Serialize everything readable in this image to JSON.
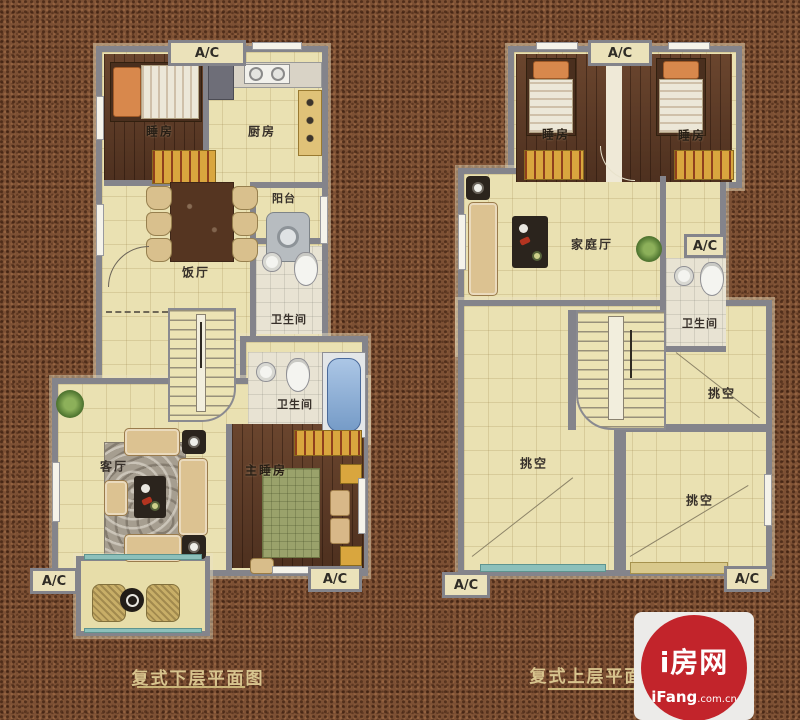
{
  "left_plan": {
    "caption": "复式下层平面图",
    "labels": {
      "ac_top": "A/C",
      "bedroom": "睡房",
      "kitchen": "厨房",
      "balcony": "阳台",
      "dining": "饭厅",
      "bathroom_upper": "卫生间",
      "bathroom_lower": "卫生间",
      "living": "客厅",
      "master_bedroom": "主睡房",
      "ac_bottom_left": "A/C",
      "ac_bottom_right": "A/C"
    }
  },
  "right_plan": {
    "caption": "复式上层平面图",
    "labels": {
      "ac_top": "A/C",
      "bedroom_left": "睡房",
      "bedroom_right": "睡房",
      "family_room": "家庭厅",
      "ac_right": "A/C",
      "bathroom": "卫生间",
      "void_left": "挑空",
      "void_upper_right": "挑空",
      "void_lower_right": "挑空",
      "ac_bottom_left": "A/C",
      "ac_bottom_right": "A/C"
    }
  },
  "logo": {
    "site_name": "i房网",
    "domain_bold": "iFang",
    "domain_suffix": ".com.cn"
  },
  "colors": {
    "background": "#7c5034",
    "floor": "#eae1b2",
    "wood": "#5f3b26",
    "wall": "#84848b",
    "wardrobe_yellow": "#d9a63e",
    "window_teal": "#8cc0bb",
    "bathtub_blue": "#7fa8d8",
    "logo_red": "#c2242b",
    "caption_text": "#d8c48e"
  }
}
